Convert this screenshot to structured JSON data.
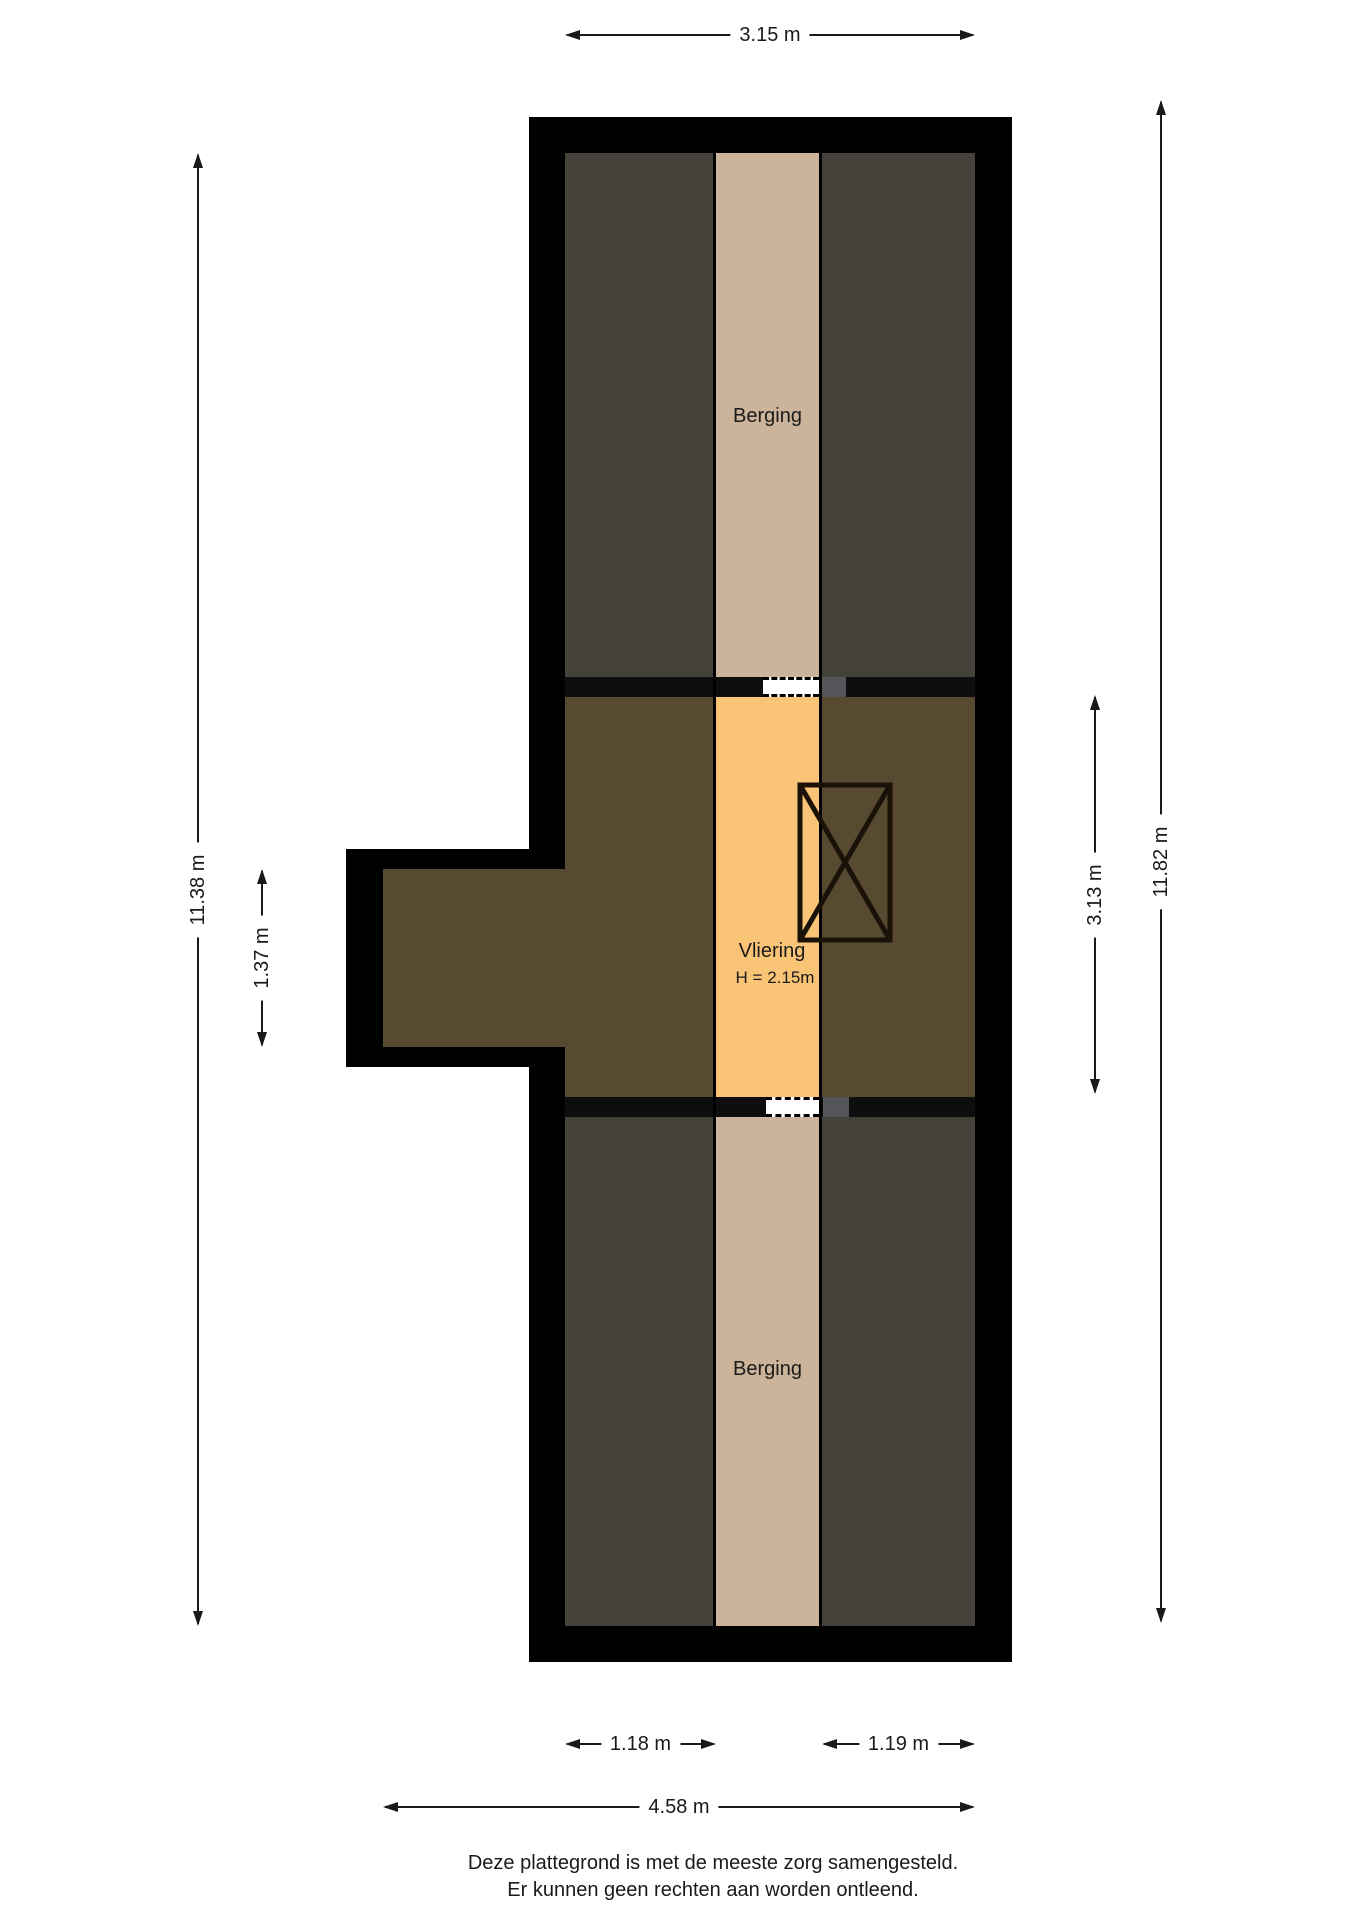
{
  "plan": {
    "rooms": {
      "berging_top": {
        "label": "Berging"
      },
      "vliering": {
        "label": "Vliering",
        "height_note": "H = 2.15m"
      },
      "berging_bottom": {
        "label": "Berging"
      }
    },
    "dimensions": {
      "top_width": "3.15 m",
      "left_height": "11.38 m",
      "left_bump_height": "1.37 m",
      "right_middle_height": "3.13 m",
      "right_height": "11.82 m",
      "bottom_left_room": "1.18 m",
      "bottom_right_room": "1.19 m",
      "bottom_total": "4.58 m"
    },
    "footer": {
      "line1": "Deze plattegrond is met de meeste zorg samengesteld.",
      "line2": "Er kunnen geen rechten aan worden ontleend."
    }
  },
  "colors": {
    "wall": "#000000",
    "band": "#0e0e0e",
    "room_dark": "#44403a",
    "room_tan": "#cbb499",
    "room_brown": "#574a31",
    "room_orange": "#fac476",
    "door_stub": "#54555a",
    "text": "#1a1a1a"
  }
}
